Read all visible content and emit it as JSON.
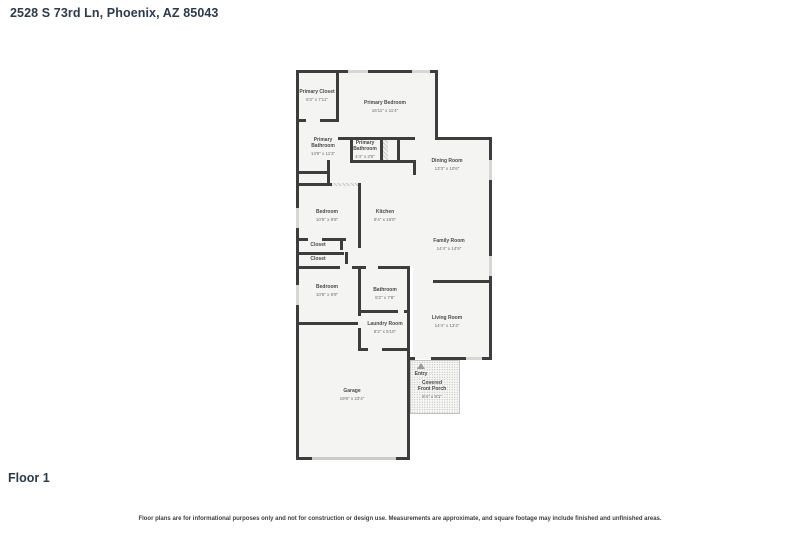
{
  "header": {
    "address": "2528 S 73rd Ln, Phoenix, AZ 85043"
  },
  "floor": {
    "label": "Floor 1"
  },
  "disclaimer": "Floor plans are for informational purposes only and not for construction or design use. Measurements are approximate, and square footage may include finished and unfinished areas.",
  "rooms": {
    "primary_closet": {
      "name": "Primary Closet",
      "dims": "6'3\" x 7'11\""
    },
    "primary_bedroom": {
      "name": "Primary Bedroom",
      "dims": "16'11\" x 11'4\""
    },
    "primary_bathroom_large": {
      "name": "Primary Bathroom",
      "dims": "14'9\" x 11'3\""
    },
    "primary_bathroom_small": {
      "name": "Primary Bathroom",
      "dims": "4'4\" x 3'5\""
    },
    "dining_room": {
      "name": "Dining Room",
      "dims": "13'3\" x 10'6\""
    },
    "bedroom_mid": {
      "name": "Bedroom",
      "dims": "10'5\" x 9'8\""
    },
    "kitchen": {
      "name": "Kitchen",
      "dims": "9'4\" x 19'0\""
    },
    "family_room": {
      "name": "Family Room",
      "dims": "14'4\" x 14'9\""
    },
    "closet_upper": {
      "name": "Closet"
    },
    "closet_lower": {
      "name": "Closet"
    },
    "bedroom_lower": {
      "name": "Bedroom",
      "dims": "10'5\" x 9'9\""
    },
    "bathroom": {
      "name": "Bathroom",
      "dims": "8'2\" x 7'8\""
    },
    "laundry_room": {
      "name": "Laundry Room",
      "dims": "8'2\" x 5'10\""
    },
    "living_room": {
      "name": "Living Room",
      "dims": "14'4\" x 13'4\""
    },
    "garage": {
      "name": "Garage",
      "dims": "19'8\" x 23'4\""
    },
    "entry": {
      "name": "Entry"
    },
    "covered_front_porch": {
      "name": "Covered Front Porch",
      "dims": "8'4\" x 9'1\""
    }
  },
  "colors": {
    "wall": "#3d3d3d",
    "room_fill": "#f4f4f3",
    "window": "#d7d7d6",
    "heading_text": "#2d3a4a",
    "label_text": "#4a4a4a"
  }
}
